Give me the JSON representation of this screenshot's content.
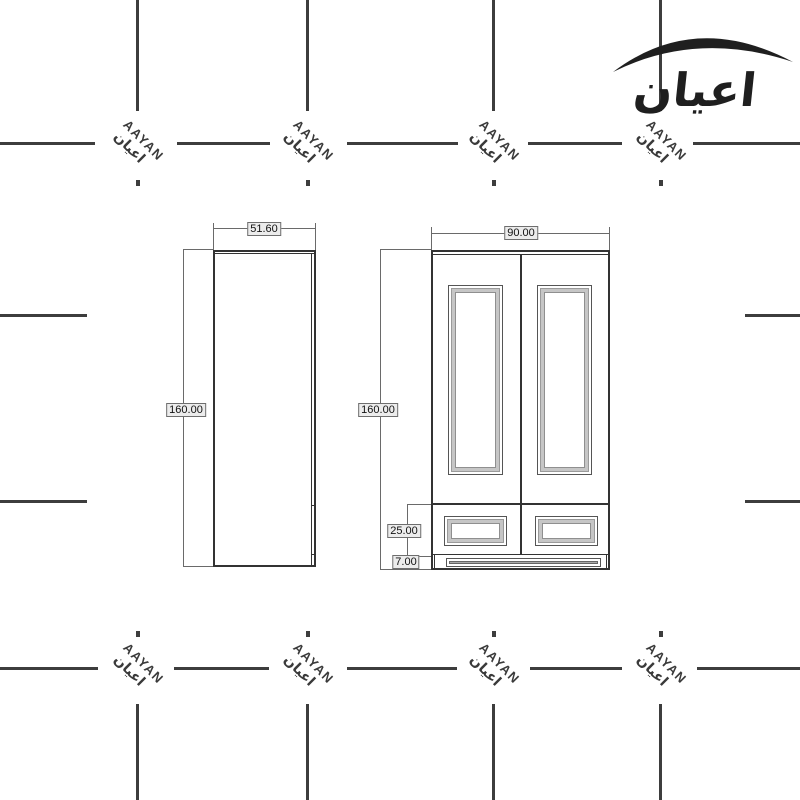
{
  "logo": {
    "text": "اعيان"
  },
  "watermark": {
    "latin": "AAYAN",
    "arabic": "اعيان"
  },
  "drawing": {
    "side_view": {
      "width_label": "51.60",
      "height_label": "160.00"
    },
    "front_view": {
      "width_label": "90.00",
      "height_label": "160.00",
      "drawer_label": "25.00",
      "plinth_label": "7.00"
    }
  },
  "colors": {
    "line": "#333333",
    "grid_mark": "#3d3d3d",
    "watermark_text": "#3a3a3a",
    "molding": "#c6c6c6",
    "label_bg": "#ececec"
  }
}
